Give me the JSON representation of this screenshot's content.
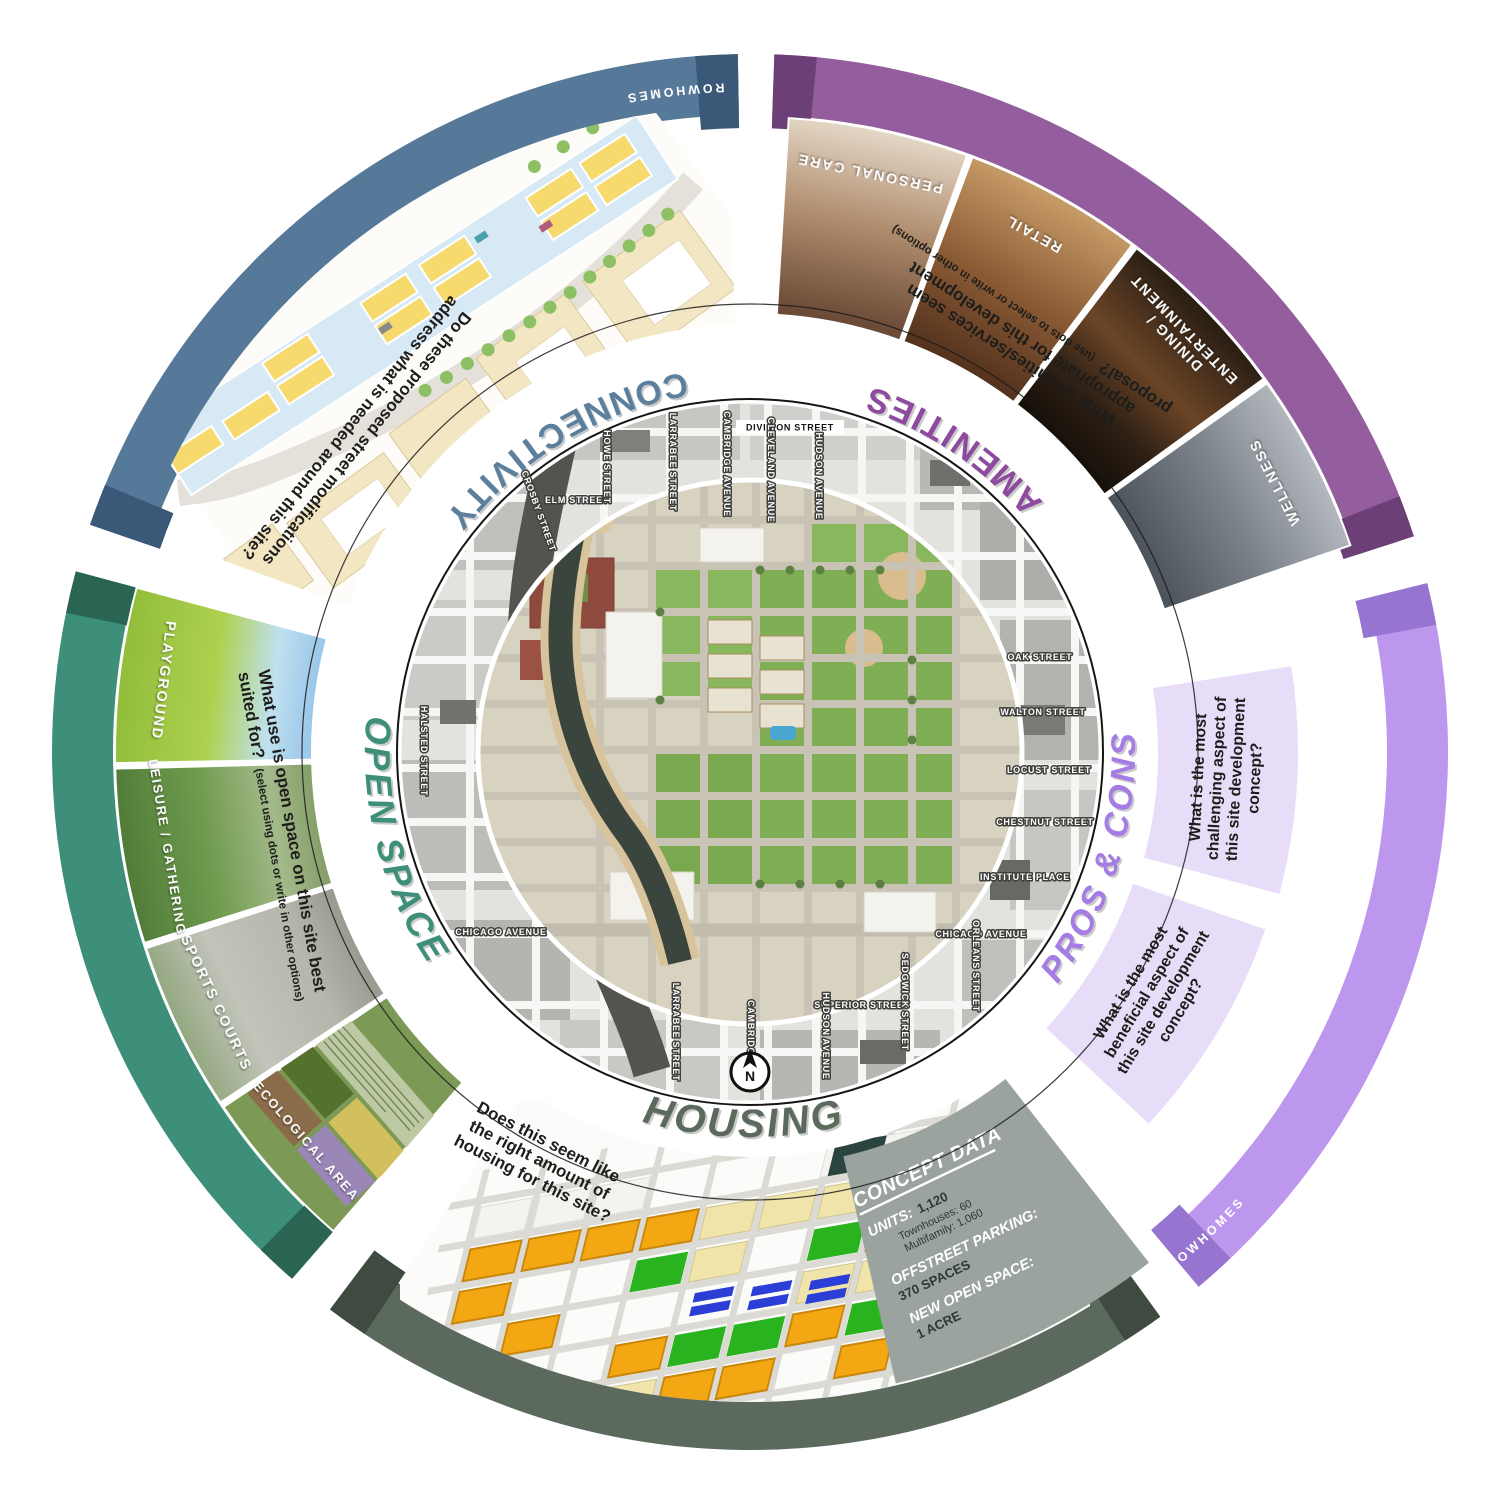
{
  "poster": {
    "concept_label": "ROWHOMES",
    "compass": "N"
  },
  "colors": {
    "connectivity": "#56799a",
    "amenities": "#935d9e",
    "pros_cons_band": "#bd97ee",
    "pros_cons_title": "#a57ce4",
    "housing": "#5c6a5e",
    "open_space": "#3d8f79",
    "question_box": "#e7ddf8",
    "concept_panel": "#9aa39e"
  },
  "sections": {
    "connectivity": {
      "title": "CONNECTIVITY",
      "question_lines": [
        "Do these proposed street modifications",
        "address what is needed around this site?"
      ]
    },
    "amenities": {
      "title": "AMENITIES",
      "question_lines": [
        "What amenities/services seem",
        "appropriate for this development",
        "proposal?"
      ],
      "question_note": "(use dots to select or write in other options)",
      "options": [
        {
          "label": "PERSONAL CARE",
          "lines": [
            "PERSONAL CARE"
          ]
        },
        {
          "label": "RETAIL",
          "lines": [
            "RETAIL"
          ]
        },
        {
          "label": "DINING / ENTERTAINMENT",
          "lines": [
            "DINING /",
            "ENTERTAINMENT"
          ]
        },
        {
          "label": "WELLNESS",
          "lines": [
            "WELLNESS"
          ]
        }
      ]
    },
    "pros_cons": {
      "title": "PROS & CONS",
      "questions": [
        {
          "lines": [
            "What is the most",
            "challenging aspect of",
            "this site development",
            "concept?"
          ]
        },
        {
          "lines": [
            "What is the most",
            "beneficial aspect of",
            "this site development",
            "concept?"
          ]
        }
      ]
    },
    "housing": {
      "title": "HOUSING",
      "question_lines": [
        "Does this seem like",
        "the right amount of",
        "housing for this site?"
      ],
      "concept_data": {
        "heading": "CONCEPT DATA",
        "units_label": "UNITS:",
        "units_value": "1,120",
        "townhouses_line": "Townhouses: 60",
        "multifamily_line": "Multifamily: 1,060",
        "parking_label": "OFFSTREET PARKING:",
        "parking_value": "370 SPACES",
        "openspace_label": "NEW OPEN SPACE:",
        "openspace_value": "1 ACRE"
      }
    },
    "open_space": {
      "title": "OPEN SPACE",
      "question_lines": [
        "What use is open space on this site best",
        "suited for?"
      ],
      "question_note": "(select using dots or write in other options)",
      "options": [
        "PLAYGROUND",
        "LEISURE / GATHERING",
        "SPORTS COURTS",
        "ECOLOGICAL AREA"
      ]
    }
  },
  "map": {
    "streets": [
      "DIVISION STREET",
      "ELM STREET",
      "HOWE STREET",
      "LARRABEE STREET",
      "CAMBRIDGE AVENUE",
      "CLEVELAND AVENUE",
      "HUDSON AVENUE",
      "OAK STREET",
      "WALTON STREET",
      "LOCUST STREET",
      "CHESTNUT STREET",
      "INSTITUTE PLACE",
      "CHICAGO AVENUE",
      "ORLEANS STREET",
      "SUPERIOR STREET",
      "SEDGWICK STREET",
      "HUDSON AVENUE",
      "CAMBRIDGE",
      "LARRABEE STREET",
      "CHICAGO AVENUE",
      "HALSTED STREET",
      "CROSBY STREET"
    ]
  }
}
